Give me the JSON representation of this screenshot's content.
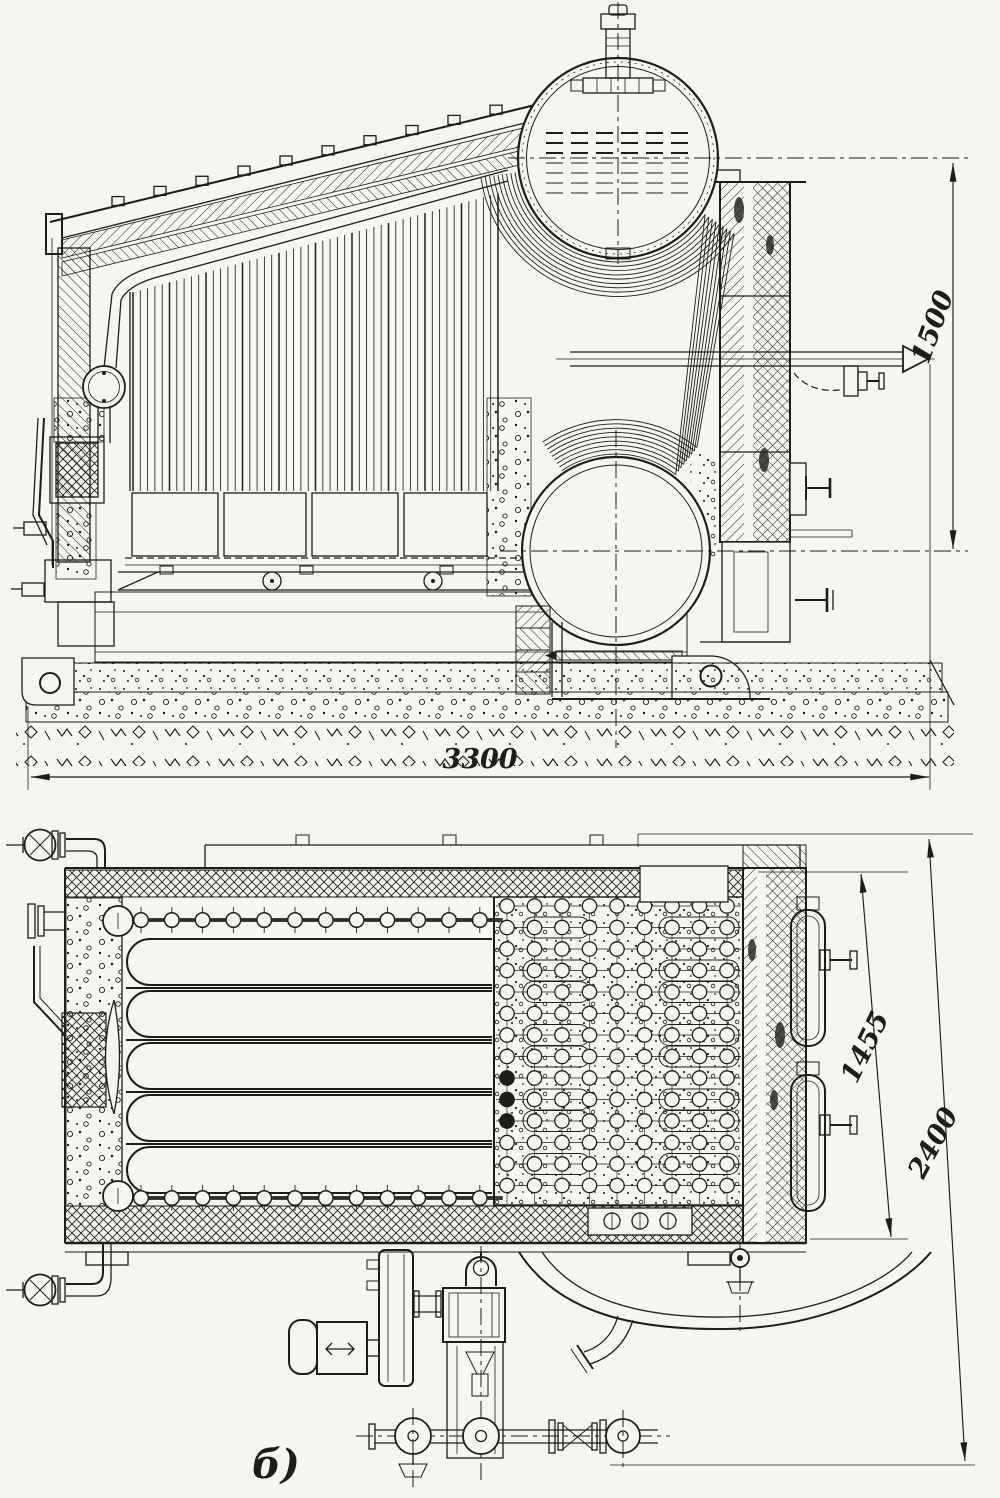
{
  "figure": {
    "view_label": "б)"
  },
  "dimensions": {
    "side_view": {
      "length": "3300",
      "height": "1500"
    },
    "plan_view": {
      "width_inner": "1455",
      "width_overall": "2400"
    }
  },
  "colors": {
    "ink": "#1e1d1b",
    "paper": "#f6f5f1"
  }
}
